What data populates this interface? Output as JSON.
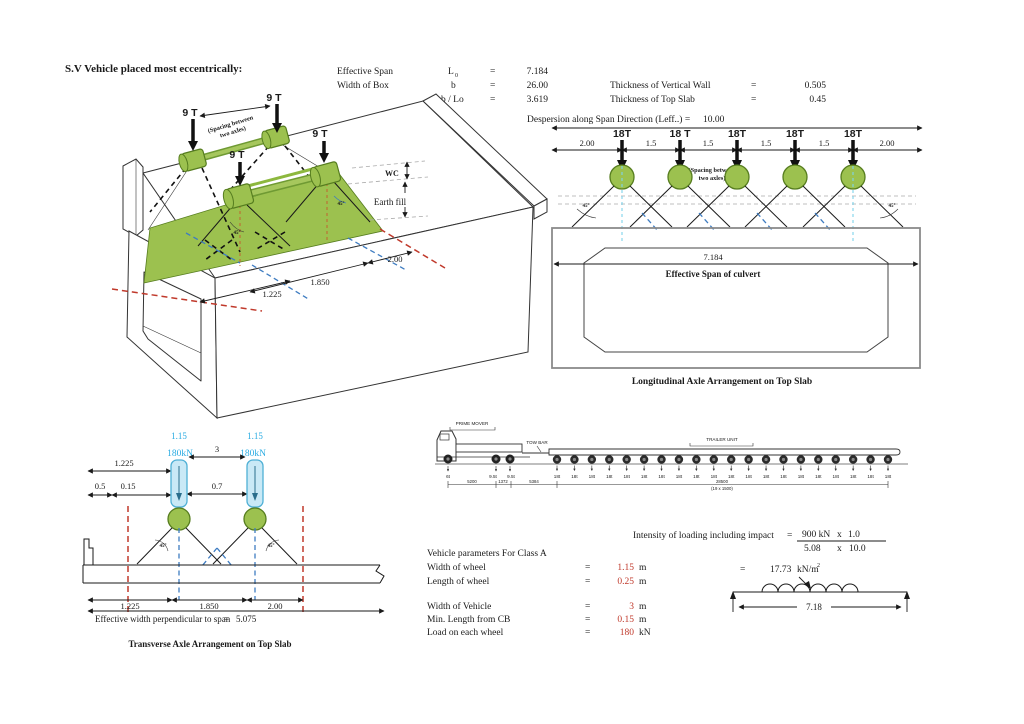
{
  "colors": {
    "green_fill": "#9CC14F",
    "green_dark": "#567D1F",
    "cyan_text": "#29ABE2",
    "wheel_blue_fill": "#C9E9F6",
    "wheel_blue_stroke": "#4FB0D5",
    "red_value": "#C0392B",
    "red_dashed": "#C0392B",
    "blue_dashed": "#3E7CC1"
  },
  "title": "S.V Vehicle placed most eccentrically:",
  "parameters": {
    "left": [
      {
        "label": "Effective Span",
        "symbol": "L",
        "symbol_sub": "0",
        "eq": "=",
        "value": "7.184"
      },
      {
        "label": "Width of Box",
        "symbol": "b",
        "symbol_sub": "",
        "eq": "=",
        "value": "26.00"
      },
      {
        "label": "",
        "symbol": "b / Lo",
        "symbol_sub": "",
        "eq": "=",
        "value": "3.619"
      }
    ],
    "right": [
      {
        "label": "Thickness of Vertical Wall",
        "eq": "=",
        "value": "0.505"
      },
      {
        "label": "Thickness of Top Slab",
        "eq": "=",
        "value": "0.45"
      }
    ]
  },
  "iso": {
    "loads": [
      "9 T",
      "9 T",
      "9 T",
      "9 T"
    ],
    "spacing_note_line1": "(Spacing between",
    "spacing_note_line2": "two axles)",
    "wc_label": "WC",
    "earth_fill_label": "Earth fill",
    "angle_label": "45°",
    "dim_1225": "1.225",
    "dim_1850": "1.850",
    "dim_200": "2.00"
  },
  "longitudinal": {
    "dispersion_label": "Despersion along Span Direction (Leff..) =",
    "dispersion_value": "10.00",
    "loads": [
      "18T",
      "18 T",
      "18T",
      "18T",
      "18T"
    ],
    "dims": [
      "2.00",
      "1.5",
      "1.5",
      "1.5",
      "1.5",
      "2.00"
    ],
    "spacing_note_line1": "(Spacing between",
    "spacing_note_line2": "two axles)",
    "angle_left": "45°",
    "angle_right": "45°",
    "span_value": "7.184",
    "span_label": "Effective Span of culvert",
    "caption": "Longitudinal Axle Arrangement on Top Slab"
  },
  "transverse": {
    "wheel_width_left": "1.15",
    "wheel_width_right": "1.15",
    "load_left": "180kN",
    "load_right": "180kN",
    "dim_gap": "3",
    "dim_1225_top": "1.225",
    "dim_05": "0.5",
    "dim_015": "0.15",
    "dim_07": "0.7",
    "angle_left": "45°",
    "angle_right": "45°",
    "dims_bottom": [
      "1.225",
      "1.850",
      "2.00"
    ],
    "eff_width_label": "Effective width perpendicular to span",
    "eff_width_eq": "=",
    "eff_width_value": "5.075",
    "caption": "Transverse Axle Arrangement on Top Slab"
  },
  "truck": {
    "prime_mover_label": "PRIME MOVER",
    "tow_bar_label": "TOW BAR",
    "trailer_unit_label": "TRAILER UNIT",
    "tractor_axle_loads": [
      "6t",
      "9.5t",
      "9.5t"
    ],
    "trailer_axle_label": "18t",
    "trailer_axle_count": 20,
    "dim_1": "5200",
    "dim_2": "1372",
    "dim_3": "5384",
    "trailer_dim": "28500",
    "trailer_dim_sub": "(19 x 1500)"
  },
  "class_a": {
    "title": "Vehicle parameters For Class A",
    "rows": [
      {
        "label": "Width of wheel",
        "eq": "=",
        "value": "1.15",
        "unit": "m"
      },
      {
        "label": "Length of wheel",
        "eq": "=",
        "value": "0.25",
        "unit": "m"
      },
      {
        "label": "Width of Vehicle",
        "eq": "=",
        "value": "3",
        "unit": "m"
      },
      {
        "label": "Min. Length from CB",
        "eq": "=",
        "value": "0.15",
        "unit": "m"
      },
      {
        "label": "Load on each wheel",
        "eq": "=",
        "value": "180",
        "unit": "kN"
      }
    ]
  },
  "intensity": {
    "label": "Intensity of loading including impact",
    "eq": "=",
    "numerator_1": "900 kN",
    "numerator_x": "x",
    "numerator_2": "1.0",
    "denominator_1": "5.08",
    "denominator_x": "x",
    "denominator_2": "10.0",
    "result_eq": "=",
    "result_value": "17.73",
    "result_unit": "kN/m",
    "result_sup": "2",
    "span_dim": "7.18"
  }
}
